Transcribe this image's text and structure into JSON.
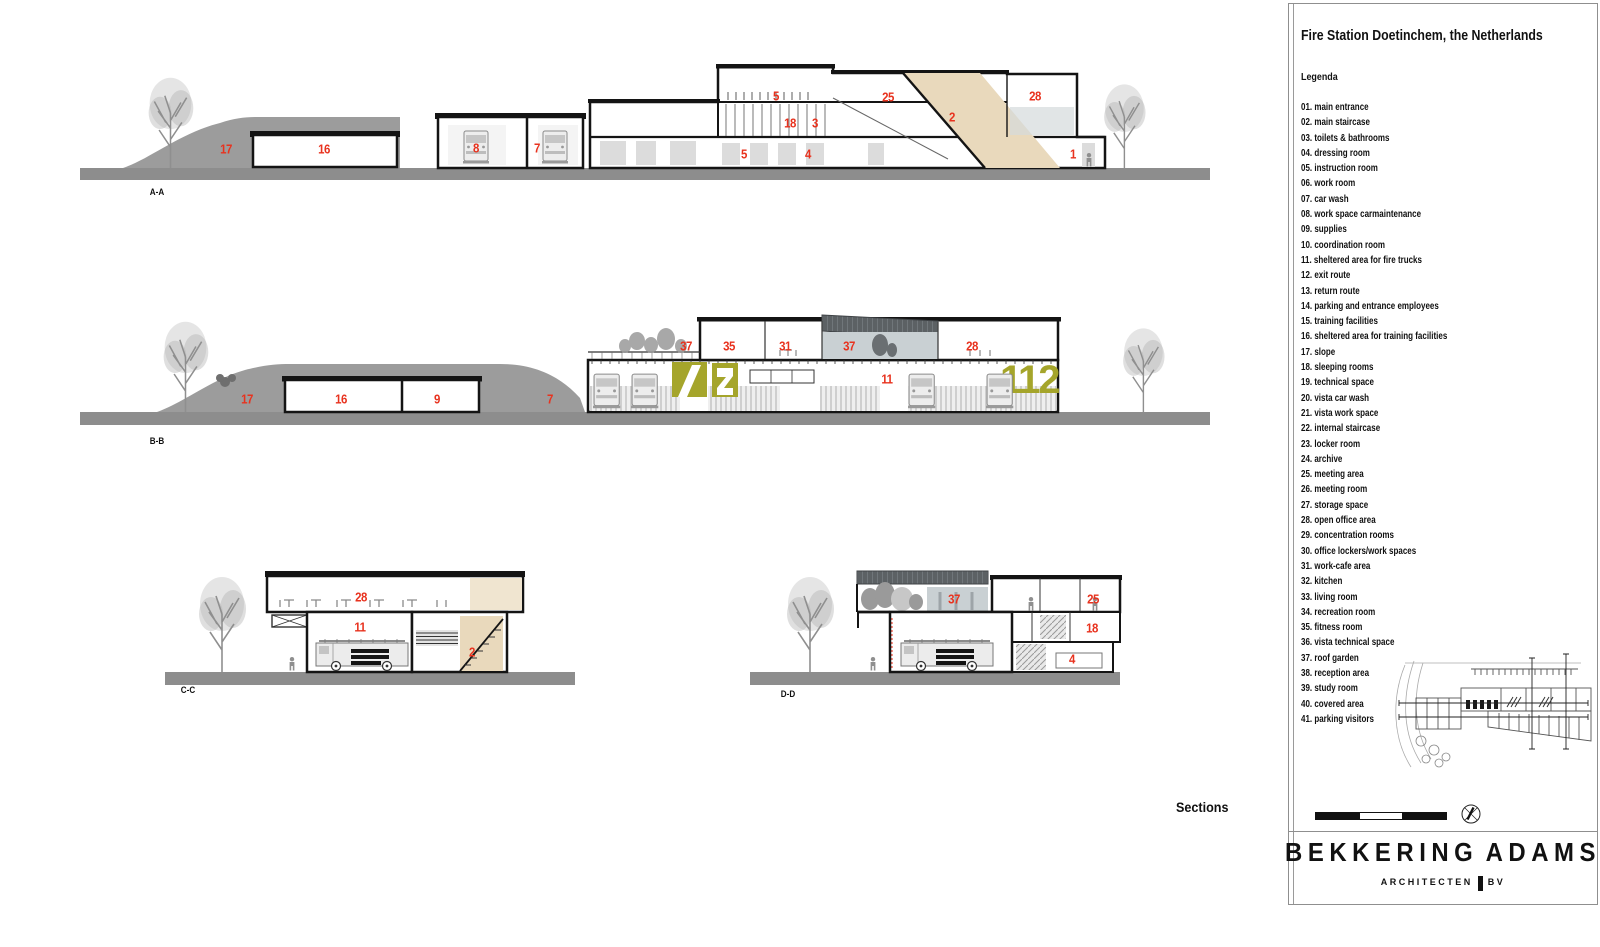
{
  "panel": {
    "title": "Fire Station Doetinchem, the Netherlands",
    "legend_title": "Legenda",
    "legend_items": [
      "01. main entrance",
      "02. main staircase",
      "03. toilets & bathrooms",
      "04. dressing room",
      "05. instruction room",
      "06. work room",
      "07. car wash",
      "08. work space carmaintenance",
      "09. supplies",
      "10. coordination room",
      "11. sheltered area for fire trucks",
      "12. exit route",
      "13. return route",
      "14. parking and entrance employees",
      "15. training facilities",
      "16. sheltered area for training facilities",
      "17. slope",
      "18. sleeping rooms",
      "19. technical space",
      "20. vista car wash",
      "21. vista work space",
      "22. internal staircase",
      "23. locker room",
      "24. archive",
      "25. meeting area",
      "26. meeting room",
      "27. storage space",
      "28. open office area",
      "29. concentration rooms",
      "30. office lockers/work spaces",
      "31. work-cafe area",
      "32. kitchen",
      "33. living room",
      "34. recreation room",
      "35. fitness room",
      "36. vista technical space",
      "37. roof garden",
      "38. reception area",
      "39. study room",
      "40. covered area",
      "41. parking visitors"
    ],
    "scale": {
      "labels": [
        "0",
        "5",
        "10",
        "15"
      ]
    },
    "logo": {
      "word1": "BEKKERING",
      "word2": "ADAMS",
      "sub1": "ARCHITECTEN",
      "sub2": "BV"
    }
  },
  "drawing": {
    "sections_title": "Sections",
    "graphic_112": "112",
    "section_marks": [
      {
        "label": "A-A",
        "x": 157,
        "y": 192
      },
      {
        "label": "B-B",
        "x": 157,
        "y": 441
      },
      {
        "label": "C-C",
        "x": 188,
        "y": 690
      },
      {
        "label": "D-D",
        "x": 788,
        "y": 694
      }
    ],
    "room_labels": [
      {
        "s": "A-A",
        "n": "17",
        "x": 226,
        "y": 149
      },
      {
        "s": "A-A",
        "n": "16",
        "x": 324,
        "y": 149
      },
      {
        "s": "A-A",
        "n": "8",
        "x": 476,
        "y": 148
      },
      {
        "s": "A-A",
        "n": "7",
        "x": 537,
        "y": 148
      },
      {
        "s": "A-A",
        "n": "5",
        "x": 776,
        "y": 96
      },
      {
        "s": "A-A",
        "n": "25",
        "x": 888,
        "y": 97
      },
      {
        "s": "A-A",
        "n": "28",
        "x": 1035,
        "y": 96
      },
      {
        "s": "A-A",
        "n": "18",
        "x": 790,
        "y": 123
      },
      {
        "s": "A-A",
        "n": "3",
        "x": 815,
        "y": 123
      },
      {
        "s": "A-A",
        "n": "2",
        "x": 952,
        "y": 117
      },
      {
        "s": "A-A",
        "n": "5",
        "x": 744,
        "y": 154
      },
      {
        "s": "A-A",
        "n": "4",
        "x": 808,
        "y": 154
      },
      {
        "s": "A-A",
        "n": "1",
        "x": 1073,
        "y": 154
      },
      {
        "s": "B-B",
        "n": "17",
        "x": 247,
        "y": 399
      },
      {
        "s": "B-B",
        "n": "16",
        "x": 341,
        "y": 399
      },
      {
        "s": "B-B",
        "n": "9",
        "x": 437,
        "y": 399
      },
      {
        "s": "B-B",
        "n": "7",
        "x": 550,
        "y": 399
      },
      {
        "s": "B-B",
        "n": "37",
        "x": 686,
        "y": 346
      },
      {
        "s": "B-B",
        "n": "35",
        "x": 729,
        "y": 346
      },
      {
        "s": "B-B",
        "n": "31",
        "x": 785,
        "y": 346
      },
      {
        "s": "B-B",
        "n": "37",
        "x": 849,
        "y": 346
      },
      {
        "s": "B-B",
        "n": "28",
        "x": 972,
        "y": 346
      },
      {
        "s": "B-B",
        "n": "11",
        "x": 887,
        "y": 379
      },
      {
        "s": "C-C",
        "n": "28",
        "x": 361,
        "y": 597
      },
      {
        "s": "C-C",
        "n": "11",
        "x": 360,
        "y": 627
      },
      {
        "s": "C-C",
        "n": "2",
        "x": 472,
        "y": 652
      },
      {
        "s": "D-D",
        "n": "37",
        "x": 954,
        "y": 599
      },
      {
        "s": "D-D",
        "n": "25",
        "x": 1093,
        "y": 599
      },
      {
        "s": "D-D",
        "n": "18",
        "x": 1092,
        "y": 628
      },
      {
        "s": "D-D",
        "n": "4",
        "x": 1072,
        "y": 659
      }
    ],
    "siteplan_markers": [
      {
        "t": "D",
        "x": 1531,
        "y": 648
      },
      {
        "t": "C",
        "x": 1565,
        "y": 650
      },
      {
        "t": "A",
        "x": 1392,
        "y": 700
      },
      {
        "t": "B",
        "x": 1392,
        "y": 714
      },
      {
        "t": "A",
        "x": 1590,
        "y": 699
      },
      {
        "t": "B",
        "x": 1592,
        "y": 713
      },
      {
        "t": "D",
        "x": 1530,
        "y": 756
      },
      {
        "t": "C",
        "x": 1564,
        "y": 756
      }
    ]
  },
  "colors": {
    "label_red": "#e8321e",
    "olive": "#a5a52b",
    "stair_beige": "#e9d9bc",
    "ground_gray": "#8d8d8d",
    "mound_gray": "#9c9c9c",
    "dark_roof": "#5c6164",
    "glass_tint": "#c9d0d3"
  }
}
